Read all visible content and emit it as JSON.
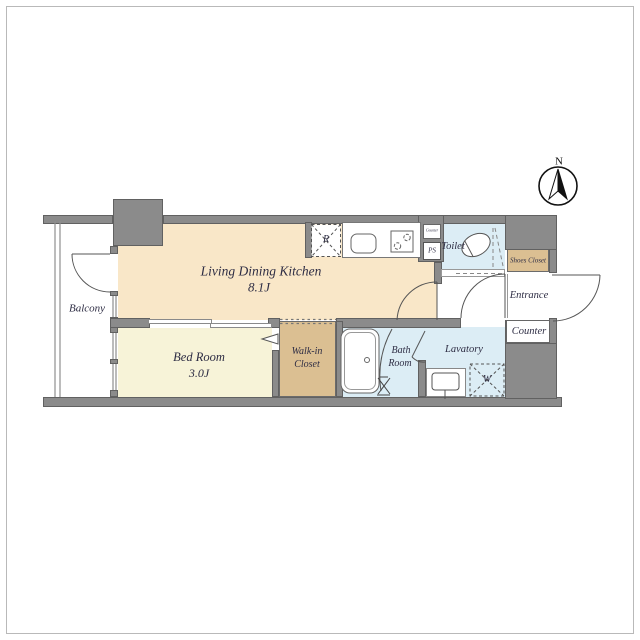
{
  "plan": {
    "title": "apartment-floor-plan",
    "compass": {
      "north_label": "N"
    },
    "rooms": {
      "ldk": {
        "name": "Living Dining Kitchen",
        "size": "8.1J"
      },
      "bedroom": {
        "name": "Bed Room",
        "size": "3.0J"
      },
      "walk_in_closet": {
        "line1": "Walk-in",
        "line2": "Closet"
      },
      "bath": {
        "line1": "Bath",
        "line2": "Room"
      },
      "lavatory": {
        "name": "Lavatory"
      },
      "toilet": {
        "name": "Toilet"
      },
      "shoes_closet": {
        "name": "Shoes Closet"
      },
      "entrance": {
        "name": "Entrance"
      },
      "counter": {
        "name": "Counter"
      },
      "balcony": {
        "name": "Balcony"
      }
    },
    "fixtures": {
      "refrigerator_label": "R",
      "pipe_space_label": "PS",
      "washing_machine_label": "W",
      "kitchen_counter_label": "Counter"
    },
    "colors": {
      "wall": "#8b8b8b",
      "wall_edge": "#616161",
      "ldk_floor": "#f9e7c8",
      "bedroom_floor": "#f7f3d8",
      "closet_floor": "#dbbf92",
      "wet_area_floor": "#dcedf5",
      "label_text": "#2e2d44"
    }
  }
}
